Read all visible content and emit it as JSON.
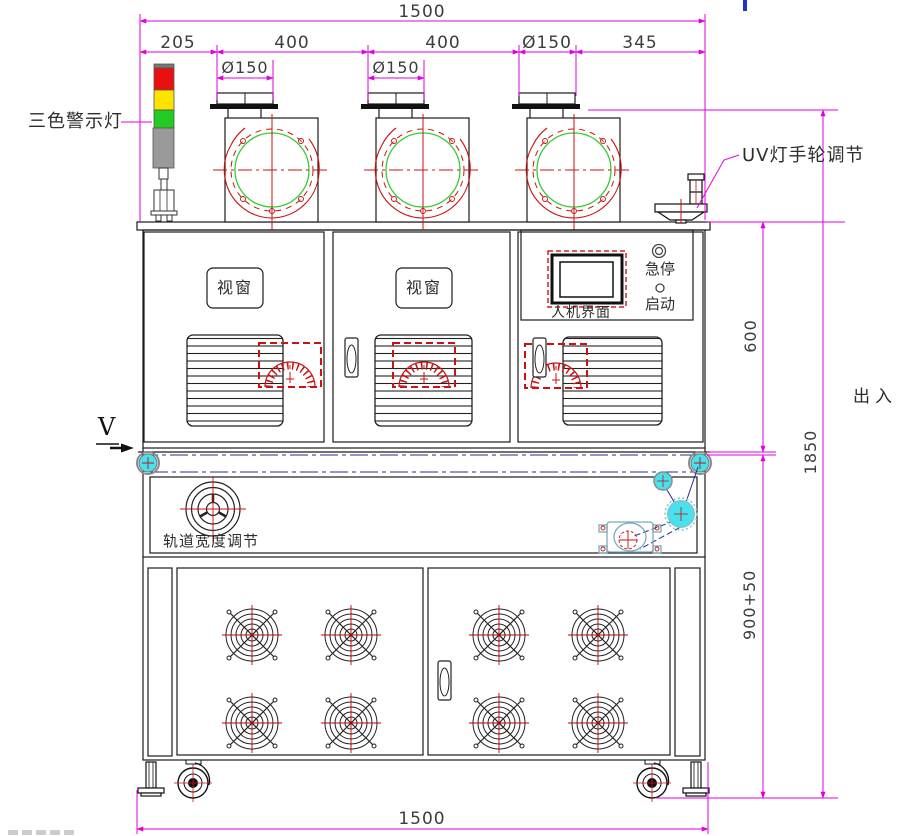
{
  "drawing": {
    "dims": {
      "top_total": "1500",
      "seg_left": "205",
      "seg_400a": "400",
      "seg_400b": "400",
      "seg_d150": "Ø150",
      "seg_right": "345",
      "blower1_dia": "Ø150",
      "blower2_dia": "Ø150",
      "right_upper": "600",
      "right_total": "1850",
      "right_lower": "900+50",
      "bottom_total": "1500"
    },
    "labels": {
      "warning_light": "三色警示灯",
      "uv_adjust": "UV灯手轮调节",
      "viewport": "视窗",
      "hmi": "人机界面",
      "emergency_stop": "急停",
      "start": "启动",
      "view_direction": "V",
      "track_width": "轨道宽度调节",
      "in_out": "出入"
    },
    "colors": {
      "dimension_magenta": "#e000e0",
      "linework": "#1a1a1a",
      "detail_red": "#cc1111",
      "inlet_green": "#33cc33",
      "pulley_cyan": "#45e2ef",
      "belt_navy": "#28288c",
      "tower_red": "#e81010",
      "tower_yellow": "#ffe300",
      "tower_green": "#22cc22",
      "tower_gray": "#9a9a9a",
      "artifact_blue": "#2233cc"
    }
  }
}
